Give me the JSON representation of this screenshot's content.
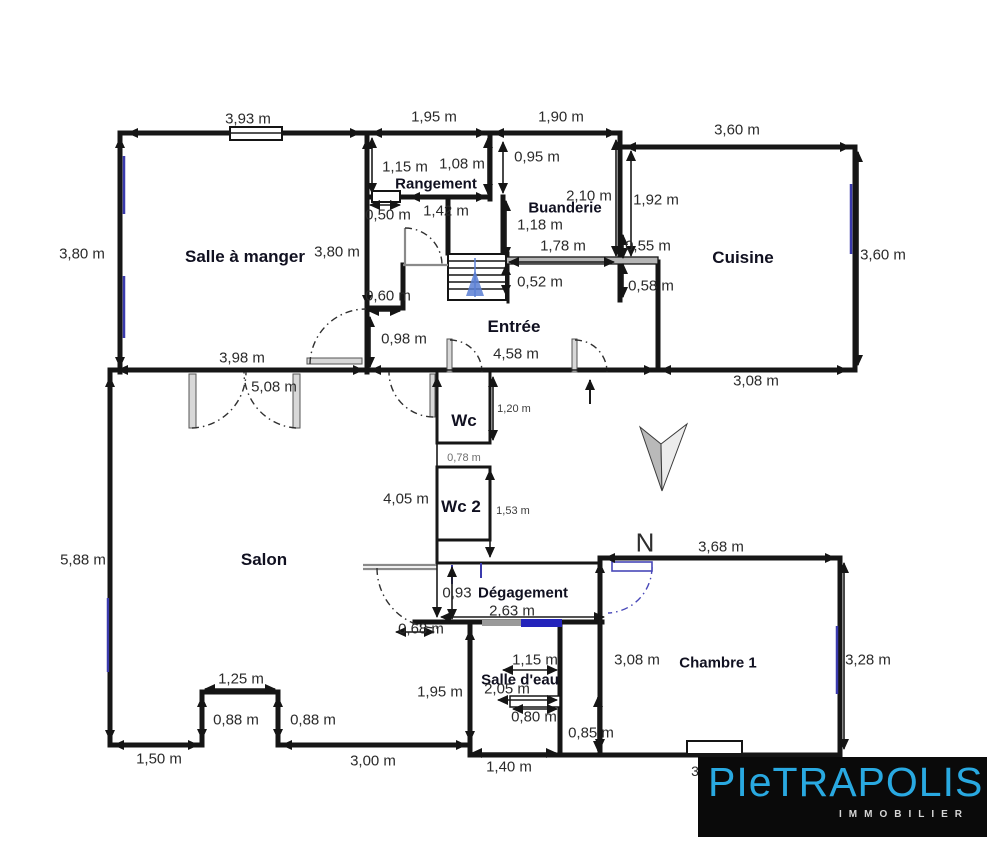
{
  "plan": {
    "rooms": {
      "salle_a_manger": "Salle à manger",
      "rangement": "Rangement",
      "buanderie": "Buanderie",
      "cuisine": "Cuisine",
      "entree": "Entrée",
      "wc": "Wc",
      "wc2": "Wc 2",
      "salon": "Salon",
      "degagement": "Dégagement",
      "salle_deau": "Salle d'eau",
      "chambre1": "Chambre 1"
    },
    "dims": {
      "d393": "3,93 m",
      "d195": "1,95 m",
      "d190": "1,90 m",
      "d360t": "3,60 m",
      "d115": "1,15 m",
      "d108": "1,08 m",
      "d095": "0,95 m",
      "d142": "1,42 m",
      "d050": "0,50 m",
      "d210": "2,10 m",
      "d192": "1,92 m",
      "d118": "1,18 m",
      "d380l": "3,80 m",
      "d380m": "3,80 m",
      "d178": "1,78 m",
      "d055": "0,55 m",
      "d360r": "3,60 m",
      "d052": "0,52 m",
      "d058": "0,58 m",
      "d060": "0,60 m",
      "d098": "0,98 m",
      "d398": "3,98 m",
      "d458": "4,58 m",
      "d308t": "3,08 m",
      "d508": "5,08 m",
      "d120": "1,20 m",
      "d078": "0,78 m",
      "d405": "4,05 m",
      "d153": "1,53 m",
      "d588": "5,88 m",
      "d368": "3,68 m",
      "d093": "0,93",
      "d263": "2,63 m",
      "d068": "0,68 m",
      "d115se": "1,15 m",
      "d308ch": "3,08 m",
      "d328": "3,28 m",
      "d125": "1,25 m",
      "d195se": "1,95 m",
      "d205": "2,05 m",
      "d088a": "0,88 m",
      "d088b": "0,88 m",
      "d080": "0,80 m",
      "d085": "0,85 m",
      "d150": "1,50 m",
      "d300": "3,00 m",
      "d140": "1,40 m",
      "frag3": "3"
    },
    "compass": {
      "north": "N"
    },
    "logo": {
      "brand": "PIeTRAPOLIS",
      "tagline": "IMMOBILIER"
    },
    "colors": {
      "wall": "#151515",
      "window_blue": "#3a3aad",
      "door_blue": "#4747b8",
      "bar_blue": "#2424bb",
      "logo_background": "#0a0a0a",
      "logo_cyan": "#29a9e1",
      "stairs_arrow_blue": "#5b7fd4"
    }
  }
}
